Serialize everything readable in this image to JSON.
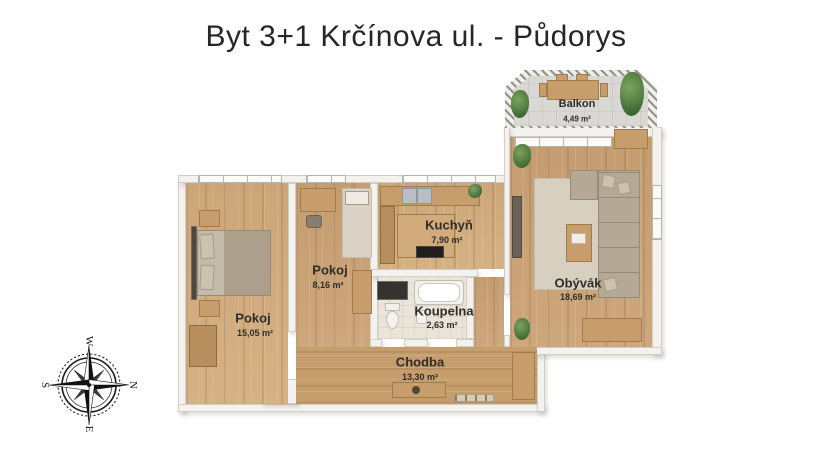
{
  "title": "Byt 3+1 Krčínova ul. - Půdorys",
  "rooms": {
    "balkon": {
      "name": "Balkon",
      "area": "4,49 m²"
    },
    "obyvak": {
      "name": "Obývák",
      "area": "18,69 m²"
    },
    "kuchyn": {
      "name": "Kuchyň",
      "area": "7,90 m²"
    },
    "pokoj_stredni": {
      "name": "Pokoj",
      "area": "8,16 m²"
    },
    "pokoj_velky": {
      "name": "Pokoj",
      "area": "15,05 m²"
    },
    "koupelna": {
      "name": "Koupelna",
      "area": "2,63 m²"
    },
    "chodba": {
      "name": "Chodba",
      "area": "13,30 m²"
    }
  },
  "compass": {
    "west": "W",
    "north": "N",
    "east": "E",
    "south": "S"
  },
  "colors": {
    "wood_floor": "#cba375",
    "wall": "#f4f2ee",
    "balcony_floor": "#d9d8d4",
    "label_text": "#2f2d29",
    "fabric": "#b5a896"
  }
}
